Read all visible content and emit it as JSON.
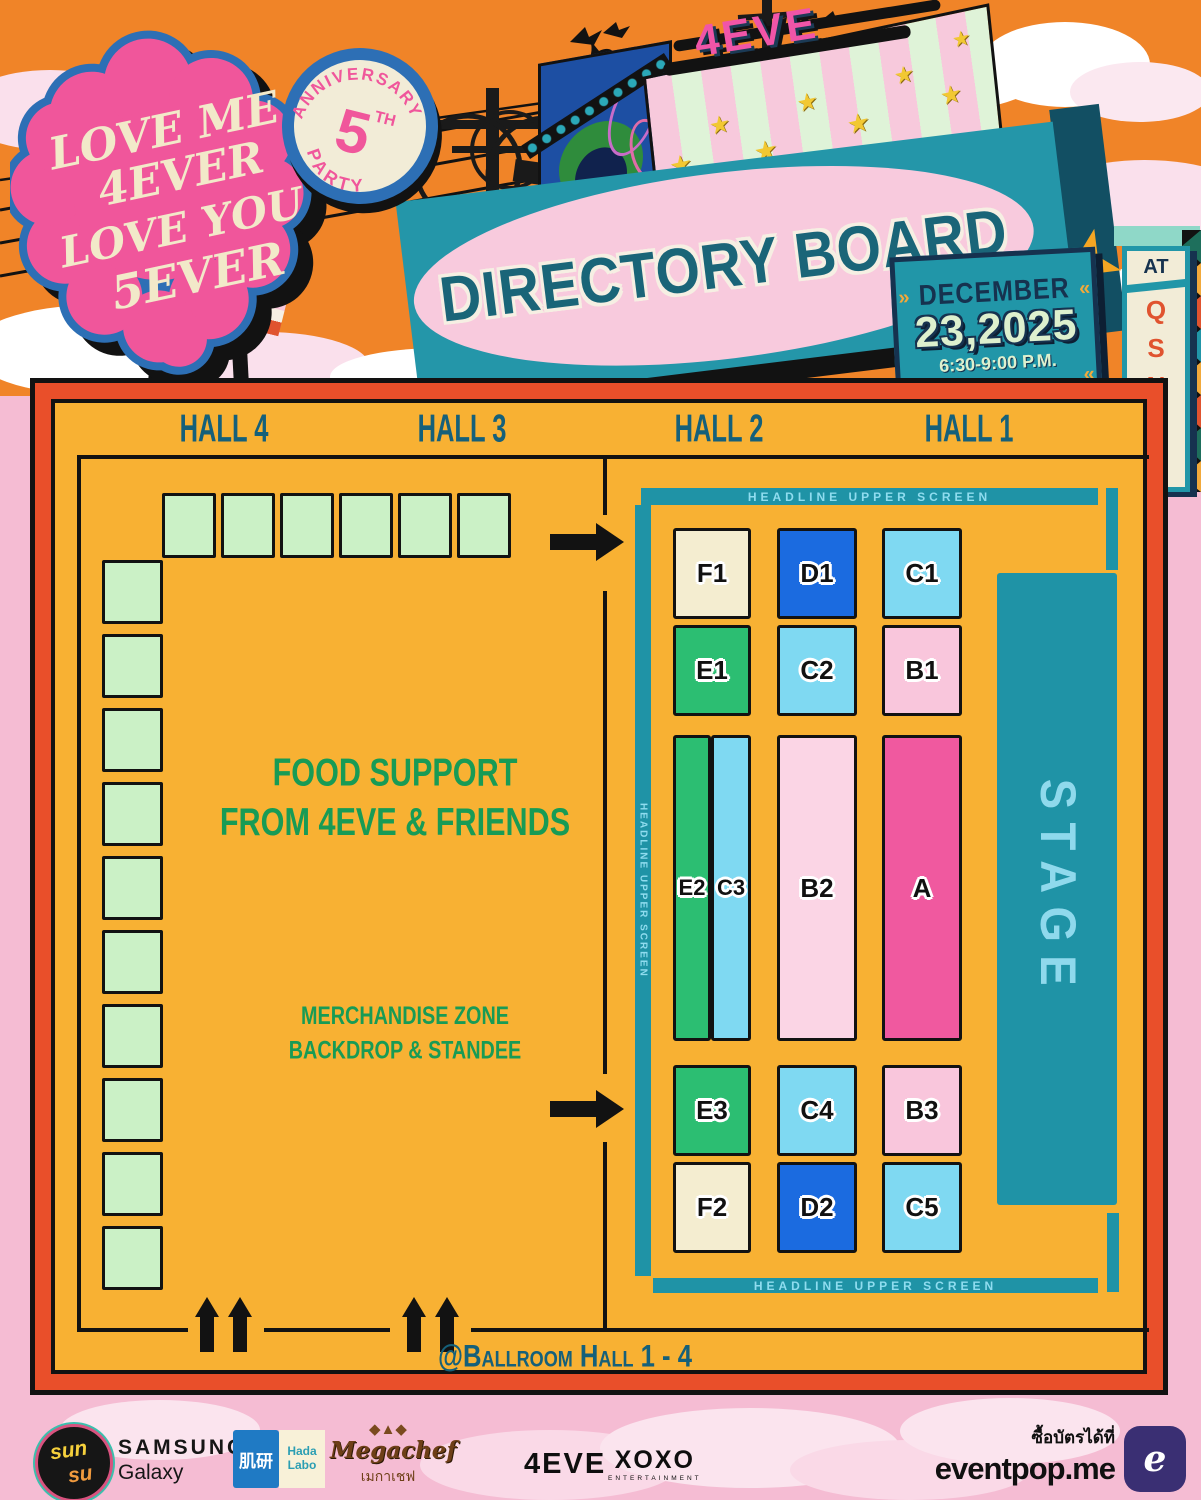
{
  "colors": {
    "board_bg": "#F8B133",
    "frame_red": "#E94F2A",
    "teal": "#2196A8",
    "teal_dark": "#124F63",
    "navy": "#16324F",
    "screen_text": "#8FDCEF",
    "hall_text": "#15607A",
    "green_text": "#189B55",
    "booth_green": "#CBF1C6",
    "heart_pink": "#F0569B",
    "heart_outline_blue": "#2D6FB5",
    "cream": "#F2E9C9",
    "orange_sky": "#F08428",
    "pink_bg": "#F5BCD3",
    "banner_pink": "#F8CADD",
    "title_text": "#1A6578",
    "qsncc_letter": "#E0532F",
    "date_number": "#DDF0CE",
    "neon_pink": "#F055A8"
  },
  "header": {
    "logo_lines": [
      "LOVE ME",
      "4EVER",
      "LOVE YOU",
      "5EVER"
    ],
    "badge": {
      "arc_top": "ANNIVERSARY",
      "number": "5",
      "suffix": "TH",
      "arc_bottom": "PARTY"
    },
    "marquee_sign": "4EVE",
    "title": "DIRECTORY BOARD",
    "date_month": "DECEMBER",
    "date_day_year": "23,2025",
    "date_time": "6:30-9:00 P.M.",
    "at_label": "AT",
    "venue_letters": [
      "Q",
      "S",
      "N",
      "C",
      "C"
    ]
  },
  "board": {
    "halls": [
      {
        "label": "HALL 4"
      },
      {
        "label": "HALL 3"
      },
      {
        "label": "HALL 2"
      },
      {
        "label": "HALL 1"
      }
    ],
    "food_line1": "FOOD SUPPORT",
    "food_line2": "FROM 4EVE & FRIENDS",
    "merch_line1": "MERCHANDISE ZONE",
    "merch_line2": "BACKDROP & STANDEE",
    "screen_label": "HEADLINE UPPER SCREEN",
    "stage_label": "STAGE",
    "ballroom_label": "@Ballroom Hall 1 - 4",
    "booths": {
      "top_row": 6,
      "left_column": 10
    },
    "zones": [
      {
        "label": "F1",
        "color": "#F4EDD0"
      },
      {
        "label": "D1",
        "color": "#1B6BE0"
      },
      {
        "label": "C1",
        "color": "#7FD9F2"
      },
      {
        "label": "E1",
        "color": "#2CBE72"
      },
      {
        "label": "C2",
        "color": "#7FD9F2"
      },
      {
        "label": "B1",
        "color": "#F9C6DC"
      },
      {
        "label": "E2",
        "color": "#2CBE72"
      },
      {
        "label": "C3",
        "color": "#7FD9F2"
      },
      {
        "label": "B2",
        "color": "#FBD5E5"
      },
      {
        "label": "A",
        "color": "#F0599F"
      },
      {
        "label": "E3",
        "color": "#2CBE72"
      },
      {
        "label": "C4",
        "color": "#7FD9F2"
      },
      {
        "label": "B3",
        "color": "#F9C6DC"
      },
      {
        "label": "F2",
        "color": "#F4EDD0"
      },
      {
        "label": "D2",
        "color": "#1B6BE0"
      },
      {
        "label": "C5",
        "color": "#7FD9F2"
      }
    ]
  },
  "sponsors": {
    "sunsu_line1": "sun",
    "sunsu_line2": "su",
    "samsung": "SAMSUNG",
    "samsung_sub": "Galaxy",
    "hadalabo_cjk": "肌研",
    "hada_line1": "Hada",
    "hada_line2": "Labo",
    "megachef": "Megachef",
    "megachef_thai": "เมกาเชฟ",
    "four_eve": "4EVE",
    "xoxo": "XOXO",
    "xoxo_sub": "ENTERTAINMENT",
    "tickets_label": "ซื้อบัตรได้ที่",
    "tickets_site": "eventpop.me",
    "eventpop_logo_letter": "e"
  }
}
